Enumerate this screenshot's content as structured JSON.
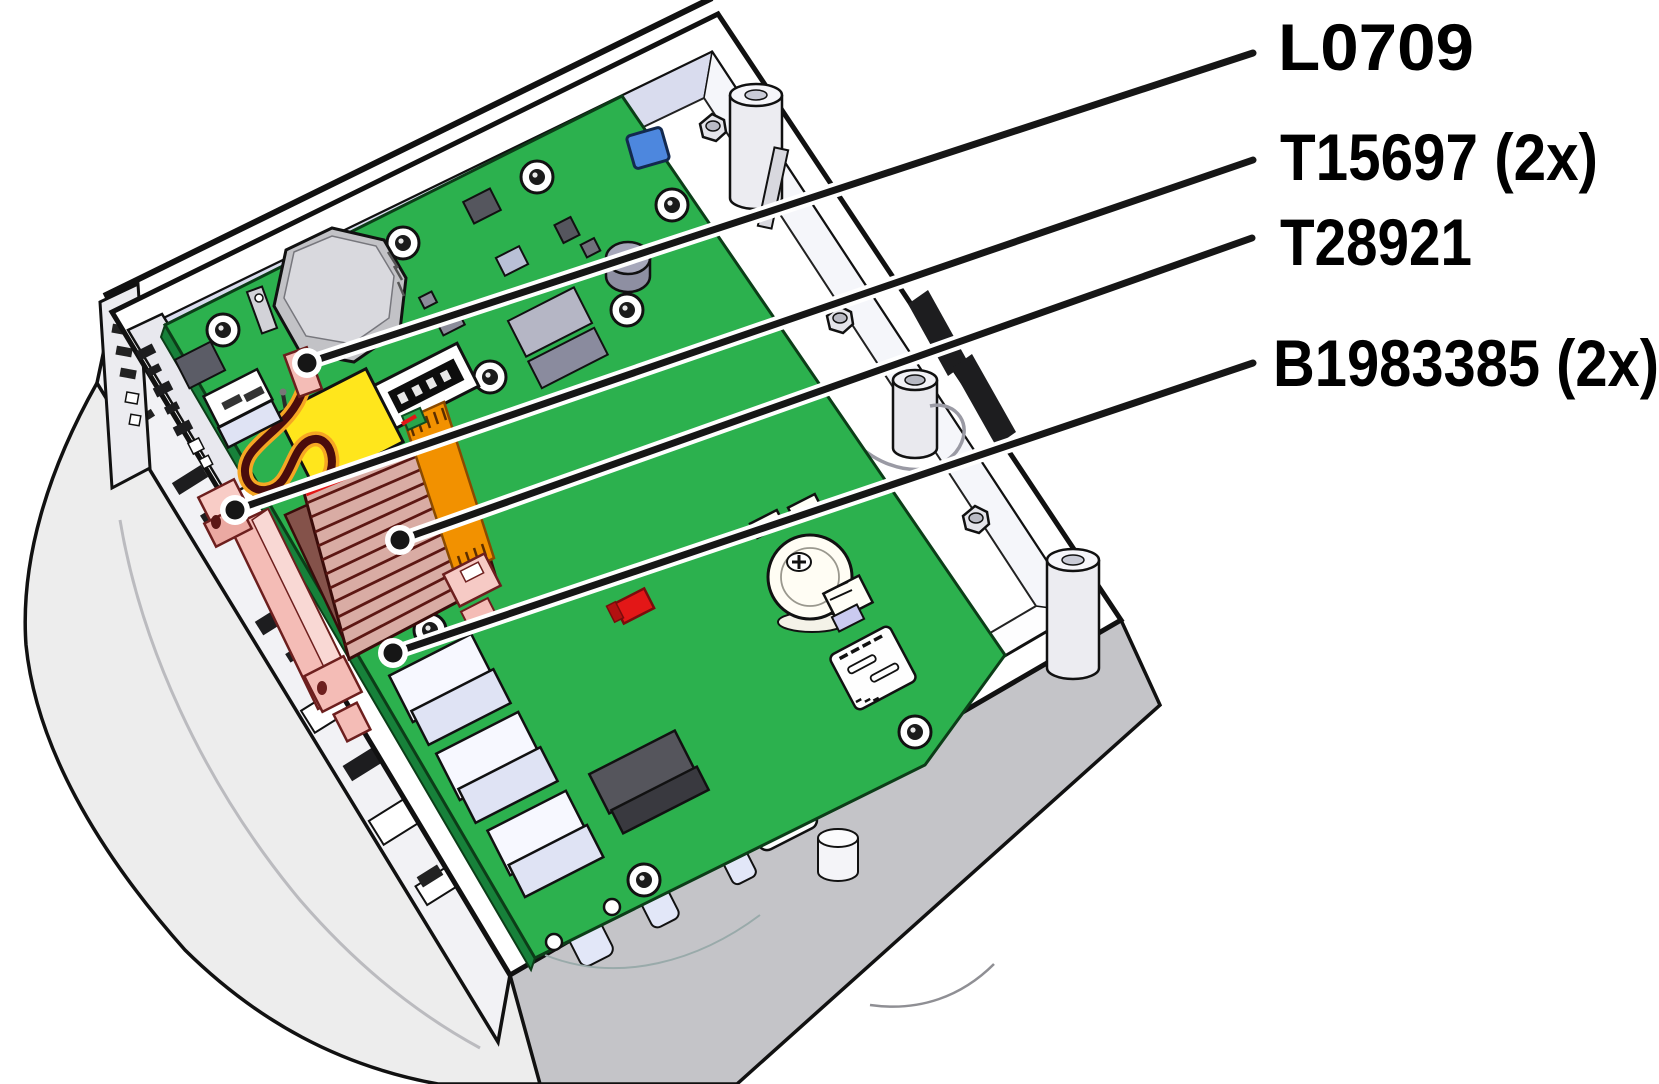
{
  "figure": {
    "type": "isometric-technical-illustration",
    "subject": "open-device-enclosure-with-main-circuit-board",
    "callouts": [
      {
        "id": "L0709",
        "label": "L0709",
        "line": {
          "x1": 1253,
          "y1": 53,
          "x2": 307,
          "y2": 363
        },
        "text": {
          "x": 1278,
          "y": 47,
          "length": 196
        }
      },
      {
        "id": "T15697",
        "label": "T15697 (2x)",
        "line": {
          "x1": 1253,
          "y1": 160,
          "x2": 235,
          "y2": 510
        },
        "text": {
          "x": 1280,
          "y": 157,
          "length": 318
        }
      },
      {
        "id": "T28921",
        "label": "T28921",
        "line": {
          "x1": 1252,
          "y1": 238,
          "x2": 400,
          "y2": 540
        },
        "text": {
          "x": 1280,
          "y": 242,
          "length": 192
        }
      },
      {
        "id": "B1983385",
        "label": "B1983385 (2x)",
        "line": {
          "x1": 1253,
          "y1": 363,
          "x2": 393,
          "y2": 653
        },
        "text": {
          "x": 1273,
          "y": 363,
          "length": 386
        }
      }
    ],
    "colors": {
      "pcb_green": "#2cb14e",
      "pcb_edge_green": "#17813a",
      "outline": "#111111",
      "callout_black": "#161616",
      "shell_gray": "#ededed",
      "skirt_gray": "#c4c4c8",
      "enclosure_white": "#ffffff",
      "wall_tint": "#d9dcee",
      "ribbon_base": "#d9aca4",
      "ribbon_stripe": "#5c1713",
      "ribbon_fold": "#84524a",
      "wire_dark_red": "#4a0c0c",
      "wire_glow_orange": "#f6a623",
      "flex_orange": "#f29100",
      "battery_yellow": "#ffe61c",
      "connector_pink": "#f4bcb6",
      "connector_pink_dark": "#6d1f1e",
      "smd_red": "#e31717",
      "chip_blue": "#4d87de",
      "component_gray": "#9b9cb0",
      "port_lavender": "#dfe3f4"
    },
    "parts": [
      {
        "name": "main-pcb"
      },
      {
        "name": "piezo-buzzer"
      },
      {
        "name": "backup-battery"
      },
      {
        "name": "battery-wire"
      },
      {
        "name": "wire-terminal"
      },
      {
        "name": "dip-switch"
      },
      {
        "name": "ribbon-cable"
      },
      {
        "name": "flex-cable"
      },
      {
        "name": "flex-socket"
      },
      {
        "name": "coin-cell-holder"
      },
      {
        "name": "micro-sd-slot"
      },
      {
        "name": "red-smd-component"
      },
      {
        "name": "blue-smd-component"
      },
      {
        "name": "io-port-blocks"
      },
      {
        "name": "mounting-screws"
      },
      {
        "name": "standoff-pillars"
      },
      {
        "name": "enclosure-shell"
      },
      {
        "name": "front-panel-cutouts"
      },
      {
        "name": "wall-vent-slots"
      }
    ]
  }
}
